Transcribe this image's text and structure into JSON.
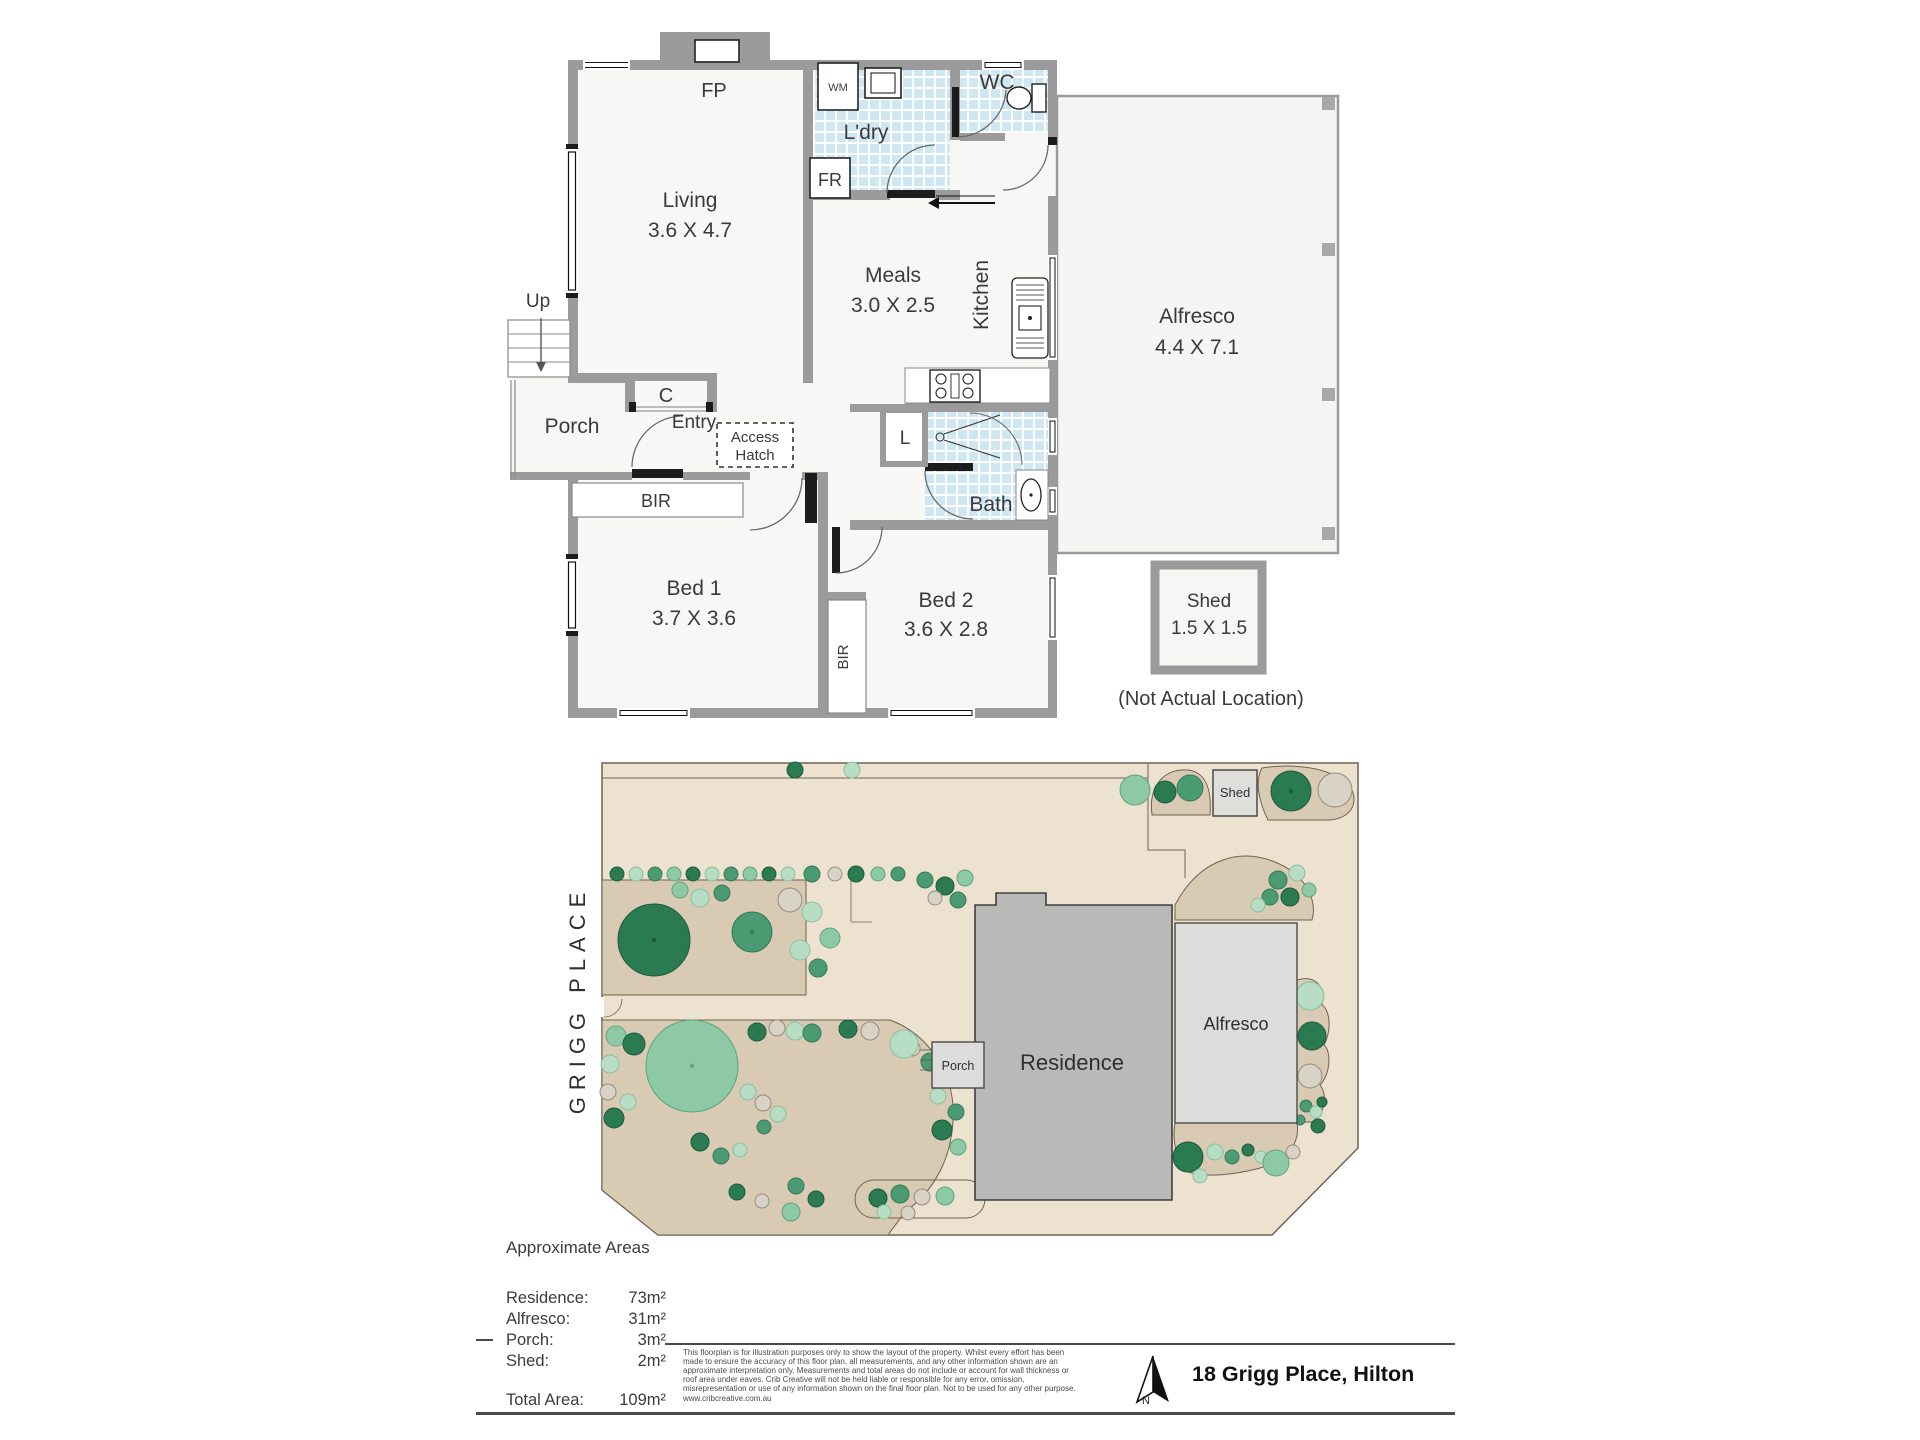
{
  "floor_plan": {
    "rooms": {
      "living": {
        "name": "Living",
        "dims": "3.6 X 4.7"
      },
      "laundry": {
        "name": "L'dry"
      },
      "wc": {
        "name": "WC"
      },
      "meals": {
        "name": "Meals",
        "dims": "3.0 X 2.5"
      },
      "kitchen": {
        "name": "Kitchen"
      },
      "alfresco": {
        "name": "Alfresco",
        "dims": "4.4 X 7.1"
      },
      "porch": {
        "name": "Porch"
      },
      "entry": {
        "name": "Entry"
      },
      "bed1": {
        "name": "Bed 1",
        "dims": "3.7 X 3.6"
      },
      "bed2": {
        "name": "Bed 2",
        "dims": "3.6 X 2.8"
      },
      "bath": {
        "name": "Bath"
      },
      "shed": {
        "name": "Shed",
        "dims": "1.5 X 1.5"
      }
    },
    "fixtures": {
      "fireplace": "FP",
      "washing_machine": "WM",
      "fridge": "FR",
      "stairs": "Up",
      "closet": "C",
      "linen": "L",
      "bir_bed1": "BIR",
      "bir_bed2": "BIR",
      "access_hatch_line1": "Access",
      "access_hatch_line2": "Hatch"
    },
    "shed_note": "(Not Actual Location)"
  },
  "site_plan": {
    "street_name": "GRIGG PLACE",
    "labels": {
      "residence": "Residence",
      "alfresco": "Alfresco",
      "porch": "Porch",
      "shed": "Shed"
    },
    "tree_colors": {
      "d": {
        "fill": "#2a7a52",
        "stroke": "#1d5a3c"
      },
      "m": {
        "fill": "#4a9b72",
        "stroke": "#357a57"
      },
      "l": {
        "fill": "#8cc9a4",
        "stroke": "#5fa57e"
      },
      "p": {
        "fill": "#b7ddc5",
        "stroke": "#8bbf9f"
      },
      "g": {
        "fill": "#d9d2c6",
        "stroke": "#968c7c"
      }
    },
    "trees": [
      [
        795,
        770,
        8,
        "d"
      ],
      [
        852,
        770,
        8,
        "p"
      ],
      [
        617,
        874,
        7,
        "d"
      ],
      [
        636,
        874,
        7,
        "p"
      ],
      [
        655,
        874,
        7,
        "m"
      ],
      [
        674,
        874,
        7,
        "l"
      ],
      [
        693,
        874,
        7,
        "d"
      ],
      [
        712,
        874,
        7,
        "p"
      ],
      [
        731,
        874,
        7,
        "m"
      ],
      [
        750,
        874,
        7,
        "l"
      ],
      [
        769,
        874,
        7,
        "d"
      ],
      [
        788,
        874,
        7,
        "p"
      ],
      [
        812,
        874,
        8,
        "m"
      ],
      [
        835,
        874,
        7,
        "g"
      ],
      [
        856,
        874,
        8,
        "d"
      ],
      [
        878,
        874,
        7,
        "l"
      ],
      [
        898,
        874,
        7,
        "m"
      ],
      [
        925,
        880,
        8,
        "m"
      ],
      [
        945,
        886,
        9,
        "d"
      ],
      [
        958,
        900,
        8,
        "m"
      ],
      [
        965,
        878,
        8,
        "l"
      ],
      [
        935,
        898,
        7,
        "g"
      ],
      [
        1135,
        790,
        15,
        "l"
      ],
      [
        1165,
        792,
        11,
        "d"
      ],
      [
        1190,
        788,
        13,
        "m"
      ],
      [
        1291,
        791,
        20,
        "d"
      ],
      [
        1335,
        790,
        17,
        "g"
      ],
      [
        654,
        940,
        36,
        "d"
      ],
      [
        752,
        932,
        20,
        "m"
      ],
      [
        700,
        898,
        9,
        "p"
      ],
      [
        722,
        893,
        8,
        "m"
      ],
      [
        790,
        900,
        12,
        "g"
      ],
      [
        812,
        912,
        10,
        "p"
      ],
      [
        800,
        950,
        10,
        "p"
      ],
      [
        818,
        968,
        9,
        "m"
      ],
      [
        830,
        938,
        10,
        "l"
      ],
      [
        680,
        890,
        8,
        "l"
      ],
      [
        692,
        1066,
        46,
        "l"
      ],
      [
        616,
        1036,
        10,
        "l"
      ],
      [
        634,
        1044,
        11,
        "d"
      ],
      [
        610,
        1064,
        9,
        "p"
      ],
      [
        608,
        1092,
        8,
        "g"
      ],
      [
        614,
        1118,
        10,
        "d"
      ],
      [
        628,
        1102,
        8,
        "p"
      ],
      [
        757,
        1032,
        9,
        "d"
      ],
      [
        777,
        1028,
        8,
        "g"
      ],
      [
        795,
        1031,
        9,
        "p"
      ],
      [
        812,
        1033,
        9,
        "m"
      ],
      [
        848,
        1029,
        9,
        "d"
      ],
      [
        870,
        1031,
        9,
        "g"
      ],
      [
        748,
        1092,
        8,
        "p"
      ],
      [
        763,
        1103,
        8,
        "g"
      ],
      [
        778,
        1114,
        8,
        "p"
      ],
      [
        764,
        1127,
        7,
        "m"
      ],
      [
        700,
        1142,
        9,
        "d"
      ],
      [
        721,
        1156,
        8,
        "m"
      ],
      [
        740,
        1150,
        7,
        "p"
      ],
      [
        796,
        1186,
        8,
        "m"
      ],
      [
        816,
        1199,
        8,
        "d"
      ],
      [
        791,
        1212,
        9,
        "l"
      ],
      [
        762,
        1201,
        7,
        "g"
      ],
      [
        737,
        1192,
        8,
        "d"
      ],
      [
        878,
        1198,
        9,
        "d"
      ],
      [
        900,
        1194,
        9,
        "m"
      ],
      [
        922,
        1197,
        8,
        "g"
      ],
      [
        945,
        1196,
        9,
        "l"
      ],
      [
        884,
        1212,
        7,
        "p"
      ],
      [
        908,
        1213,
        7,
        "g"
      ],
      [
        912,
        1048,
        8,
        "g"
      ],
      [
        930,
        1062,
        9,
        "m"
      ],
      [
        947,
        1077,
        9,
        "d"
      ],
      [
        938,
        1096,
        8,
        "p"
      ],
      [
        956,
        1112,
        8,
        "m"
      ],
      [
        942,
        1130,
        10,
        "d"
      ],
      [
        958,
        1147,
        8,
        "l"
      ],
      [
        904,
        1044,
        14,
        "p"
      ],
      [
        1278,
        880,
        9,
        "m"
      ],
      [
        1297,
        873,
        8,
        "p"
      ],
      [
        1290,
        897,
        9,
        "d"
      ],
      [
        1270,
        897,
        8,
        "m"
      ],
      [
        1309,
        890,
        7,
        "l"
      ],
      [
        1258,
        905,
        7,
        "p"
      ],
      [
        1310,
        996,
        14,
        "p"
      ],
      [
        1312,
        1036,
        14,
        "d"
      ],
      [
        1310,
        1076,
        12,
        "g"
      ],
      [
        1306,
        1106,
        6,
        "m"
      ],
      [
        1316,
        1112,
        6,
        "p"
      ],
      [
        1322,
        1102,
        5,
        "d"
      ],
      [
        1318,
        1126,
        7,
        "d"
      ],
      [
        1300,
        1120,
        5,
        "m"
      ],
      [
        1188,
        1157,
        15,
        "d"
      ],
      [
        1215,
        1152,
        8,
        "p"
      ],
      [
        1232,
        1157,
        7,
        "m"
      ],
      [
        1248,
        1150,
        6,
        "d"
      ],
      [
        1261,
        1157,
        6,
        "p"
      ],
      [
        1276,
        1163,
        13,
        "l"
      ],
      [
        1293,
        1152,
        7,
        "g"
      ],
      [
        1200,
        1176,
        7,
        "p"
      ]
    ]
  },
  "areas": {
    "title": "Approximate Areas",
    "rows": [
      {
        "label": "Residence:",
        "value": "73m²"
      },
      {
        "label": "Alfresco:",
        "value": "31m²"
      },
      {
        "label": "Porch:",
        "value": "3m²"
      },
      {
        "label": "Shed:",
        "value": "2m²"
      }
    ],
    "total_label": "Total Area:",
    "total_value": "109m²"
  },
  "disclaimer": {
    "text": "This floorplan is for illustration purposes only to show the layout of the property. Whilst every effort has been made to ensure the accuracy of this floor plan, all measurements, and any other information shown are an approximate interpretation only. Measurements and total areas do not include or account for wall thickness or roof area under eaves. Crib Creative will not be held liable or responsible for any error, omission, misrepresentation or use of any information shown on the final floor plan. Not to be used for any other purpose.",
    "website": "www.cribcreative.com.au"
  },
  "footer": {
    "address": "18 Grigg Place, Hilton",
    "north_label": "N"
  }
}
